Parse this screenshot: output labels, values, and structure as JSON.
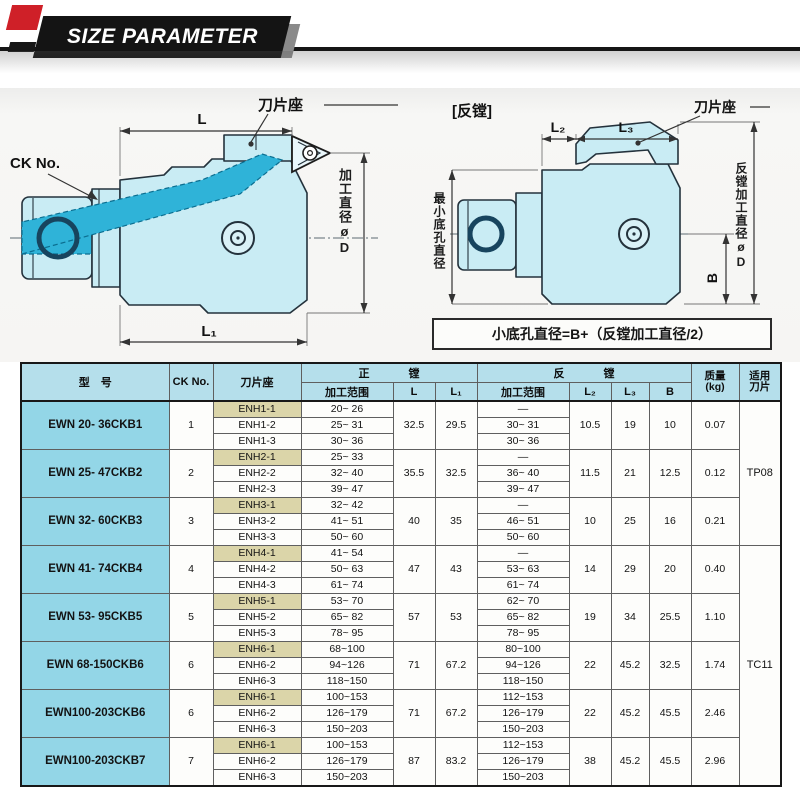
{
  "header": {
    "title": "SIZE PARAMETER"
  },
  "colors": {
    "accent_red": "#cf2028",
    "banner_black": "#141414",
    "table_header_blue": "#b5dfeb",
    "model_cell_blue": "#93d6e7",
    "seat_first_tan": "#dbd5a9",
    "diagram_body_cyan": "#c9ecf4",
    "diagram_band_cyan": "#2fb3d8"
  },
  "diagram_left": {
    "ck_no": "CK No.",
    "blade_seat": "刀片座",
    "dim_l": "L",
    "dim_l1": "L₁",
    "dia_label": "加工直径øD"
  },
  "diagram_right": {
    "title": "[反镗]",
    "blade_seat": "刀片座",
    "dim_l2": "L₂",
    "dim_l3": "L₃",
    "dim_b": "B",
    "min_hole_label": "最小底孔直径",
    "rev_dia_label": "反镗加工直径øD",
    "formula": "小底孔直径=B+（反镗加工直径/2）"
  },
  "table": {
    "headers": {
      "model": "型　号",
      "ck_no": "CK No.",
      "seat": "刀片座",
      "forward": "正　镗",
      "reverse": "反　镗",
      "range": "加工范围",
      "l": "L",
      "l1": "L₁",
      "l2": "L₂",
      "l3": "L₃",
      "b": "B",
      "weight": "质量",
      "weight_unit": "(kg)",
      "insert_line1": "适用",
      "insert_line2": "刀片"
    },
    "models": [
      {
        "model": "EWN 20- 36CKB1",
        "ck": "1",
        "seats": [
          "ENH1-1",
          "ENH1-2",
          "ENH1-3"
        ],
        "fwd_ranges": [
          "20~ 26",
          "25~ 31",
          "30~ 36"
        ],
        "L": "32.5",
        "L1": "29.5",
        "rev_ranges": [
          "—",
          "30~ 31",
          "30~ 36"
        ],
        "L2": "10.5",
        "L3": "19",
        "B": "10",
        "kg": "0.07"
      },
      {
        "model": "EWN 25- 47CKB2",
        "ck": "2",
        "seats": [
          "ENH2-1",
          "ENH2-2",
          "ENH2-3"
        ],
        "fwd_ranges": [
          "25~ 33",
          "32~ 40",
          "39~ 47"
        ],
        "L": "35.5",
        "L1": "32.5",
        "rev_ranges": [
          "—",
          "36~ 40",
          "39~ 47"
        ],
        "L2": "11.5",
        "L3": "21",
        "B": "12.5",
        "kg": "0.12"
      },
      {
        "model": "EWN 32- 60CKB3",
        "ck": "3",
        "seats": [
          "ENH3-1",
          "ENH3-2",
          "ENH3-3"
        ],
        "fwd_ranges": [
          "32~ 42",
          "41~ 51",
          "50~ 60"
        ],
        "L": "40",
        "L1": "35",
        "rev_ranges": [
          "—",
          "46~ 51",
          "50~ 60"
        ],
        "L2": "10",
        "L3": "25",
        "B": "16",
        "kg": "0.21"
      },
      {
        "model": "EWN 41- 74CKB4",
        "ck": "4",
        "seats": [
          "ENH4-1",
          "ENH4-2",
          "ENH4-3"
        ],
        "fwd_ranges": [
          "41~ 54",
          "50~ 63",
          "61~ 74"
        ],
        "L": "47",
        "L1": "43",
        "rev_ranges": [
          "—",
          "53~ 63",
          "61~ 74"
        ],
        "L2": "14",
        "L3": "29",
        "B": "20",
        "kg": "0.40"
      },
      {
        "model": "EWN 53- 95CKB5",
        "ck": "5",
        "seats": [
          "ENH5-1",
          "ENH5-2",
          "ENH5-3"
        ],
        "fwd_ranges": [
          "53~ 70",
          "65~ 82",
          "78~ 95"
        ],
        "L": "57",
        "L1": "53",
        "rev_ranges": [
          "62~ 70",
          "65~ 82",
          "78~ 95"
        ],
        "L2": "19",
        "L3": "34",
        "B": "25.5",
        "kg": "1.10"
      },
      {
        "model": "EWN 68-150CKB6",
        "ck": "6",
        "seats": [
          "ENH6-1",
          "ENH6-2",
          "ENH6-3"
        ],
        "fwd_ranges": [
          "68~100",
          "94~126",
          "118~150"
        ],
        "L": "71",
        "L1": "67.2",
        "rev_ranges": [
          "80~100",
          "94~126",
          "118~150"
        ],
        "L2": "22",
        "L3": "45.2",
        "B": "32.5",
        "kg": "1.74"
      },
      {
        "model": "EWN100-203CKB6",
        "ck": "6",
        "seats": [
          "ENH6-1",
          "ENH6-2",
          "ENH6-3"
        ],
        "fwd_ranges": [
          "100~153",
          "126~179",
          "150~203"
        ],
        "L": "71",
        "L1": "67.2",
        "rev_ranges": [
          "112~153",
          "126~179",
          "150~203"
        ],
        "L2": "22",
        "L3": "45.2",
        "B": "45.5",
        "kg": "2.46"
      },
      {
        "model": "EWN100-203CKB7",
        "ck": "7",
        "seats": [
          "ENH6-1",
          "ENH6-2",
          "ENH6-3"
        ],
        "fwd_ranges": [
          "100~153",
          "126~179",
          "150~203"
        ],
        "L": "87",
        "L1": "83.2",
        "rev_ranges": [
          "112~153",
          "126~179",
          "150~203"
        ],
        "L2": "38",
        "L3": "45.2",
        "B": "45.5",
        "kg": "2.96"
      }
    ],
    "insert_groups": [
      {
        "label": "TP08",
        "start_model": 0,
        "model_span": 3
      },
      {
        "label": "TC11",
        "start_model": 3,
        "model_span": 5
      }
    ]
  }
}
